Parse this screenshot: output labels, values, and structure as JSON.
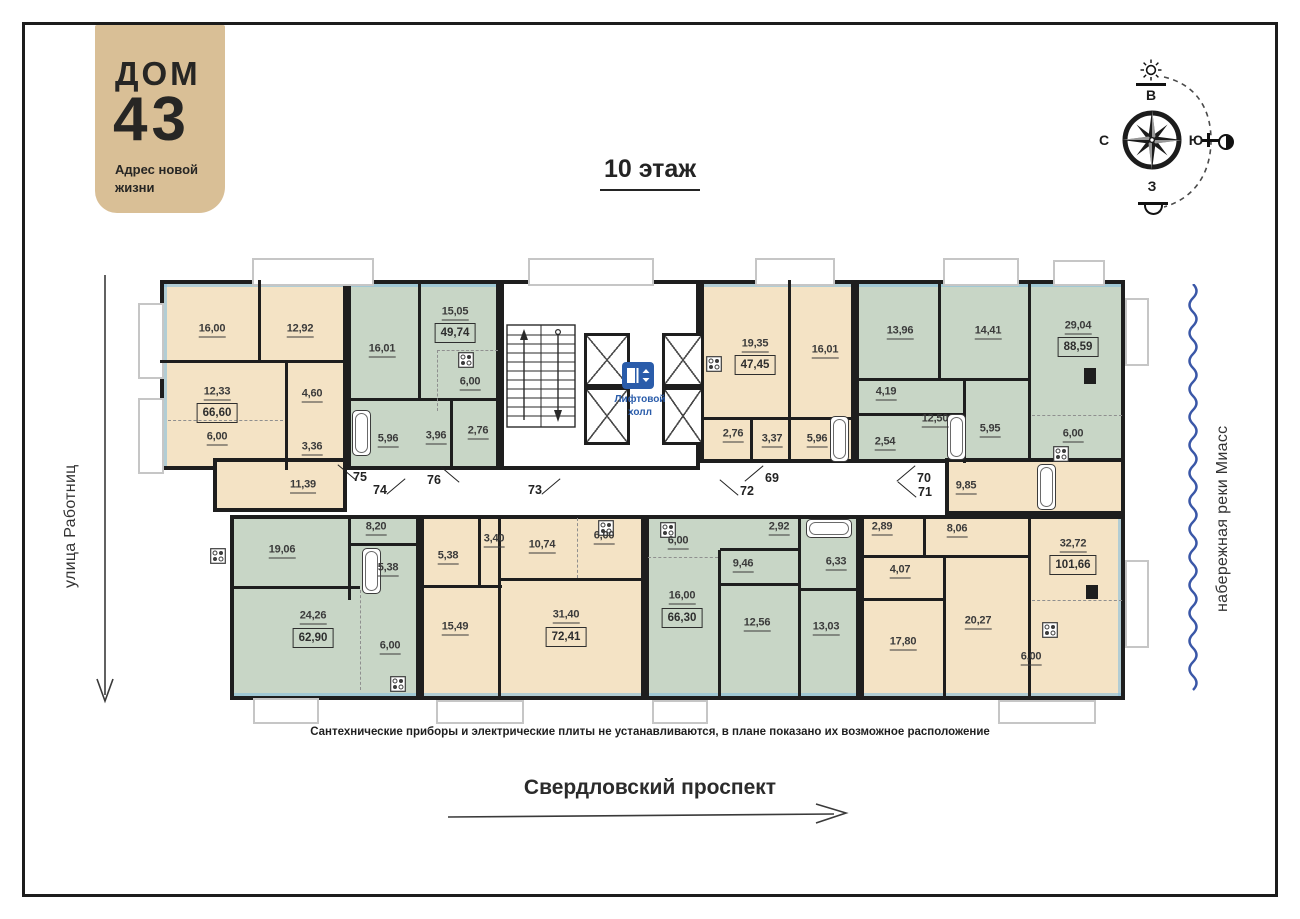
{
  "logo": {
    "brand_line": "ДОМ",
    "brand_number": "43",
    "tagline": "Адрес новой жизни"
  },
  "header": {
    "floor_title": "10 этаж"
  },
  "compass": {
    "top": "В",
    "right": "Ю",
    "bottom": "З",
    "left": "С"
  },
  "surroundings": {
    "street_left": "улица Работниц",
    "embankment_right": "набережная реки Миасс",
    "street_bottom": "Свердловский проспект"
  },
  "footnote": "Сантехнические приборы и электрические плиты не устанавливаются, в плане показано их возможное расположение",
  "core": {
    "elevator_hall": "Лифтовой холл"
  },
  "colors": {
    "apartment_beige": "#f4e3c5",
    "apartment_green": "#c8d6c6",
    "wall": "#1e1e1e",
    "accent_blue": "#2a5caa",
    "river_blue": "#3a57a7",
    "logo_background": "#d9bf96"
  },
  "icons": [
    "compass-rose-icon",
    "sun-rise-icon",
    "sun-set-icon",
    "moon-icon",
    "elevator-icon",
    "stairs-icon",
    "bathtub-icon",
    "stove-icon",
    "river-wave-icon"
  ],
  "apartments": [
    {
      "number": "75",
      "palette": "beige",
      "total_area": "66,60",
      "rooms": [
        "16,00",
        "12,92",
        "12,33",
        "6,00",
        "4,60",
        "3,36",
        "11,39"
      ]
    },
    {
      "number": "76",
      "palette": "green",
      "total_area": "49,74",
      "rooms": [
        "15,05",
        "16,01",
        "6,00",
        "5,96",
        "3,96",
        "2,76"
      ]
    },
    {
      "number": "69",
      "palette": "beige",
      "total_area": "47,45",
      "rooms": [
        "19,35",
        "16,01",
        "2,76",
        "3,37",
        "5,96"
      ]
    },
    {
      "number": "70",
      "palette": "green",
      "total_area": "88,59",
      "rooms": [
        "13,96",
        "14,41",
        "29,04",
        "4,19",
        "12,50",
        "2,54",
        "5,95",
        "6,00"
      ]
    },
    {
      "number": "71",
      "palette": "beige",
      "total_area": "101,66",
      "rooms": [
        "9,85",
        "2,89",
        "8,06",
        "4,07",
        "17,80",
        "20,27",
        "32,72",
        "6,00"
      ]
    },
    {
      "number": "72",
      "palette": "green",
      "total_area": "66,30",
      "rooms": [
        "6,00",
        "16,00",
        "2,92",
        "9,46",
        "12,56",
        "6,33",
        "13,03"
      ]
    },
    {
      "number": "73",
      "palette": "beige",
      "total_area": "72,41",
      "rooms": [
        "5,38",
        "3,40",
        "10,74",
        "6,00",
        "15,49",
        "31,40"
      ]
    },
    {
      "number": "74",
      "palette": "green",
      "total_area": "62,90",
      "rooms": [
        "19,06",
        "8,20",
        "5,38",
        "24,26",
        "6,00"
      ]
    }
  ]
}
